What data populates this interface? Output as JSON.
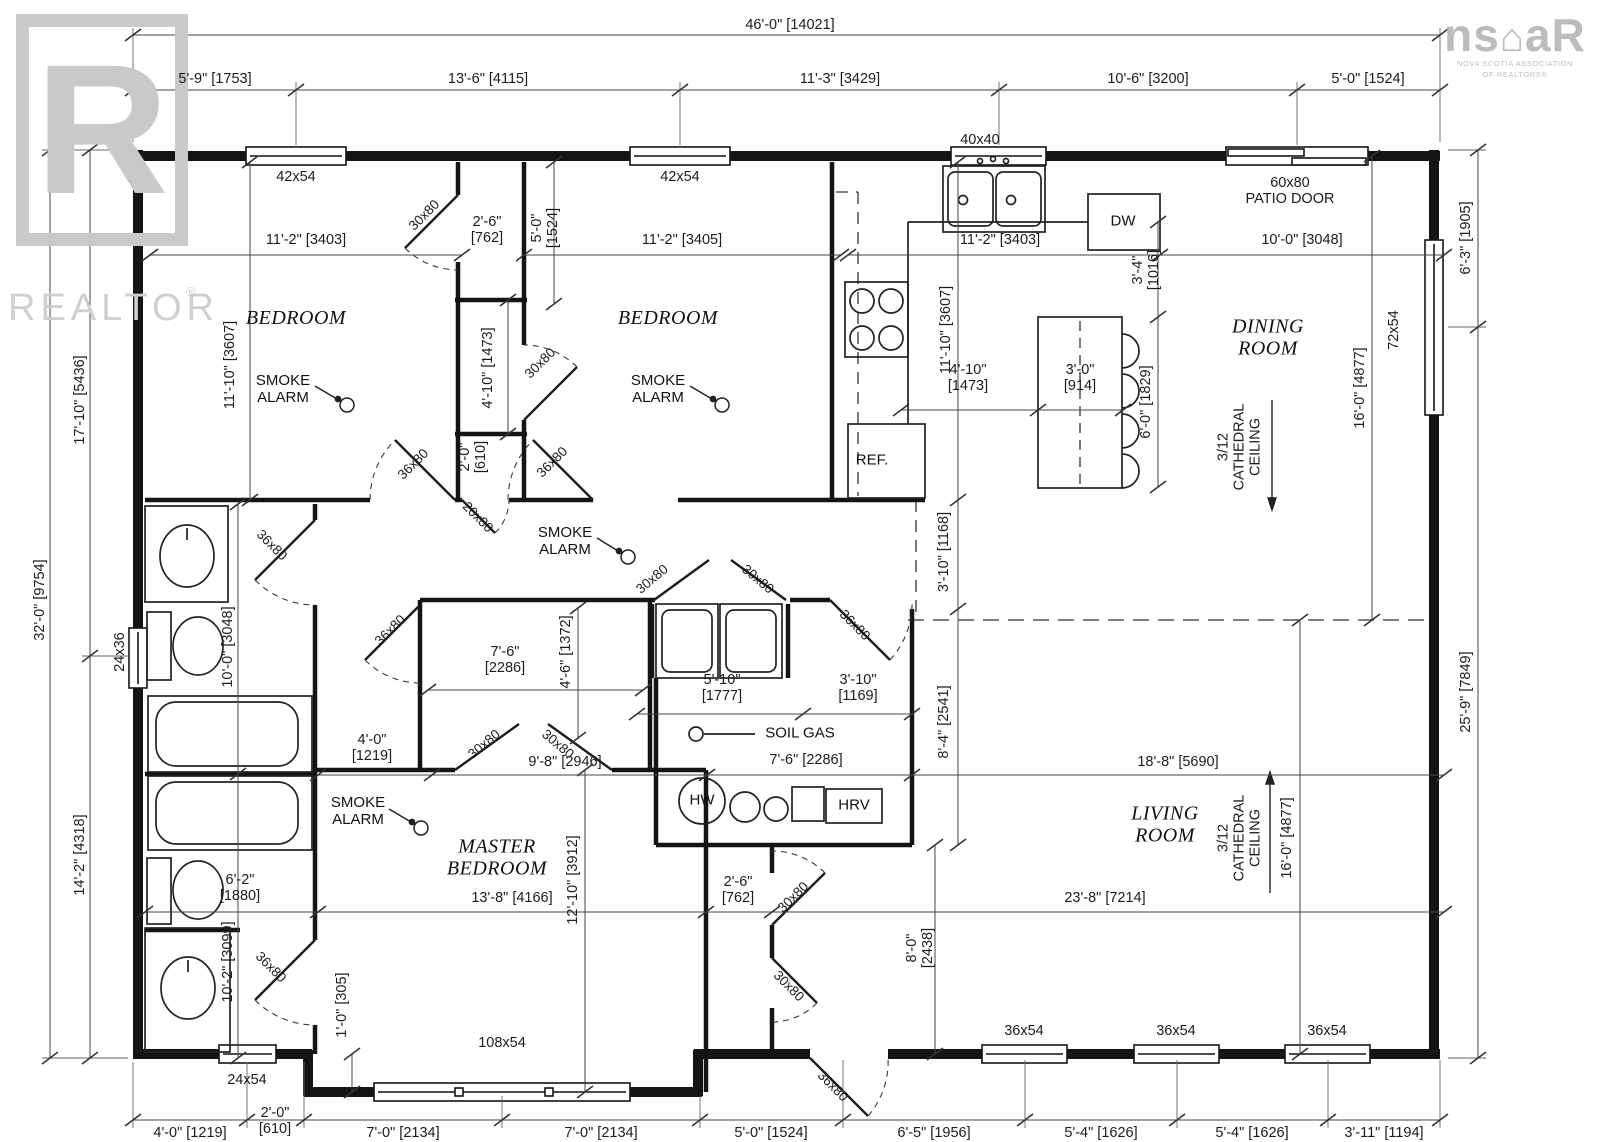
{
  "watermark": {
    "r_letter": "R",
    "realtor": "REALTOR",
    "reg": "®",
    "ns": "ns",
    "ar": "aR",
    "house": "⌂",
    "nova": "NOVA SCOTIA ASSOCIATION",
    "of_r": "OF REALTORS®"
  },
  "rooms": {
    "bedroom": "BEDROOM",
    "dining": "DINING\nROOM",
    "living": "LIVING\nROOM",
    "master": "MASTER\nBEDROOM"
  },
  "fixtures": {
    "ref": "REF.",
    "dw": "DW",
    "hw": "HW",
    "hrv": "HRV",
    "smoke": "SMOKE\nALARM",
    "soil": "SOIL GAS"
  },
  "annotations": {
    "cath": "3/12\nCATHEDRAL\nCEILING"
  },
  "doors": {
    "d30": "30x80",
    "d36": "36x80",
    "d20": "20x80"
  },
  "windows": {
    "w40": "40x40",
    "w42": "42x54",
    "w72": "72x54",
    "w36": "36x54",
    "w24x36": "24x36",
    "w24x54": "24x54",
    "w108": "108x54",
    "patio": "60x80\nPATIO DOOR"
  },
  "dims": {
    "d46": "46'-0\" [14021]",
    "d5_9": "5'-9\" [1753]",
    "d13_6": "13'-6\" [4115]",
    "d11_3": "11'-3\" [3429]",
    "d10_6": "10'-6\" [3200]",
    "d5_0": "5'-0\" [1524]",
    "d11_2_3403": "11'-2\" [3403]",
    "d11_2_3405": "11'-2\" [3405]",
    "d10_0": "10'-0\" [3048]",
    "d6_3": "6'-3\" [1905]",
    "d2_6": "2'-6\"\n[762]",
    "d5_0c": "5'-0\"\n[1524]",
    "d11_10": "11'-10\" [3607]",
    "d4_10": "4'-10\" [1473]",
    "d4_10_2": "4'-10\"\n[1473]",
    "d3_0": "3'-0\"\n[914]",
    "d3_4": "3'-4\"\n[1016]",
    "d6_0": "6'-0\" [1829]",
    "d16_0": "16'-0\" [4877]",
    "d2_0": "2'-0\"\n[610]",
    "d3_10v": "3'-10\" [1168]",
    "d8_4": "8'-4\" [2541]",
    "d17_10": "17'-10\" [5436]",
    "d32_0": "32'-0\" [9754]",
    "d14_2": "14'-2\" [4318]",
    "d7_6c": "7'-6\"\n[2286]",
    "d4_6": "4'-6\" [1372]",
    "d5_10": "5'-10\"\n[1777]",
    "d3_10b": "3'-10\"\n[1169]",
    "d4_0m": "4'-0\"\n[1219]",
    "d9_8": "9'-8\" [2946]",
    "d7_6u": "7'-6\" [2286]",
    "d18_8": "18'-8\" [5690]",
    "d12_10": "12'-10\" [3912]",
    "d13_8": "13'-8\" [4166]",
    "d23_8": "23'-8\" [7214]",
    "d6_2": "6'-2\"\n[1880]",
    "d8_0": "8'-0\"\n[2438]",
    "d25_9": "25'-9\" [7849]",
    "d10_2": "10'-2\" [3099]",
    "d1_0": "1'-0\" [305]",
    "b4_0": "4'-0\" [1219]",
    "b7_0": "7'-0\" [2134]",
    "b6_5": "6'-5\" [1956]",
    "b5_4": "5'-4\" [1626]",
    "b3_11": "3'-11\" [1194]"
  }
}
